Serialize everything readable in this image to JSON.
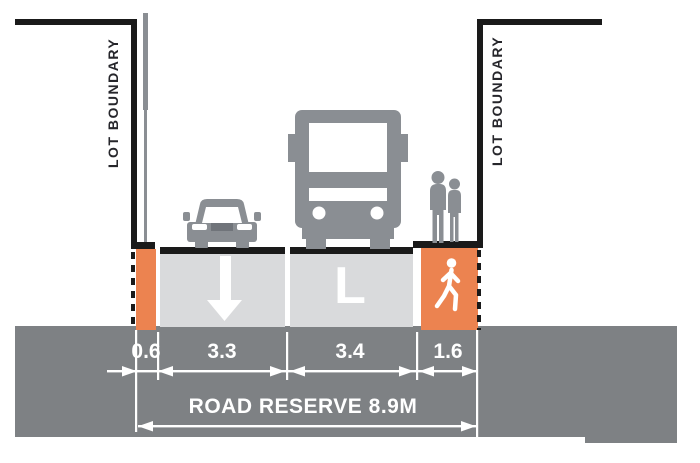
{
  "diagram": {
    "type": "road-cross-section",
    "lot_boundary_label": "LOT BOUNDARY",
    "road_reserve_label": "ROAD RESERVE 8.9M",
    "lane_marking_letter": "L",
    "dimension_labels": [
      "0.6",
      "3.3",
      "3.4",
      "1.6"
    ],
    "icons": [
      "car-icon",
      "truck-icon",
      "pedestrians-icon",
      "walking-person-icon",
      "down-arrow-icon"
    ],
    "colors": {
      "line_black": "#1a1a1a",
      "figure_gray": "#8a8e93",
      "road_surface_gray": "#d9dadc",
      "ground_gray": "#7e8184",
      "verge_orange": "#ec8350",
      "dimension_white": "#ffffff"
    }
  }
}
